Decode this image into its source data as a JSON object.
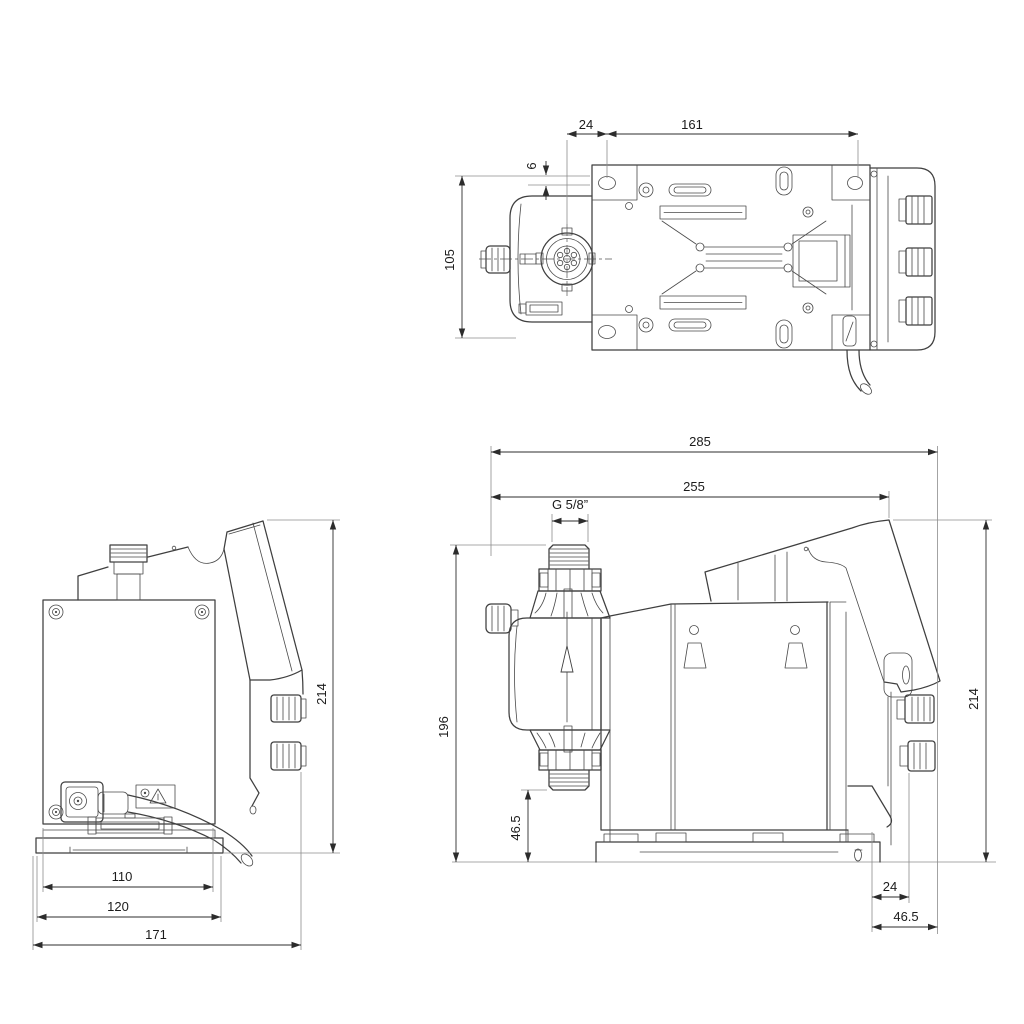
{
  "page": {
    "background": "#ffffff"
  },
  "drawing": {
    "title": "pump-dimensional-drawing",
    "line_color": "#3f3f3f",
    "dim_color": "#1c1c1c",
    "views": {
      "top": {
        "name": "top view",
        "dims": {
          "offset_24": "24",
          "span_161": "161",
          "offset_6": "6",
          "width_105": "105"
        }
      },
      "rear": {
        "name": "rear view",
        "dims": {
          "height_214": "214",
          "plate_110": "110",
          "base_120": "120",
          "overall_171": "171"
        }
      },
      "side": {
        "name": "side view",
        "dims": {
          "overall_285": "285",
          "depth_255": "255",
          "thread": "G 5/8”",
          "height_196": "196",
          "valve_height_46_5": "46.5",
          "height_214": "214",
          "rear_24": "24",
          "rear_46_5": "46.5"
        }
      }
    }
  }
}
